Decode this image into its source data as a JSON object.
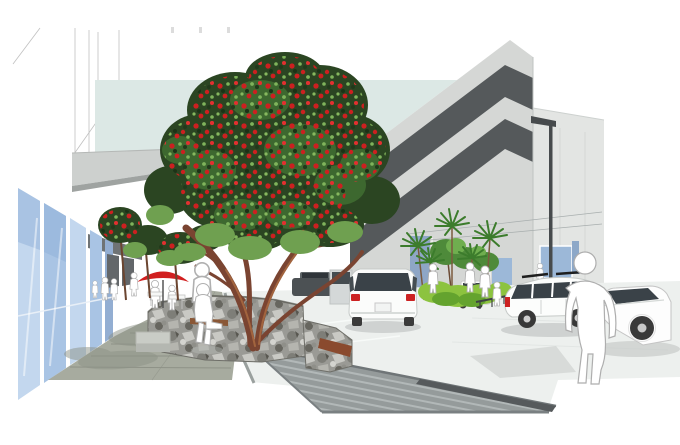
{
  "scene": {
    "type": "architectural concept rendering",
    "setting": "shared street with flowering pohutukawa trees, cafe seating, footpath, parking court and parking building",
    "background": "#ffffff"
  },
  "counts": {
    "pedestrian_figures": 14,
    "cars": 7,
    "street_lights": 1,
    "umbrellas": 1,
    "cabbage_trees": 5
  },
  "elements": [
    "left retail verandah and glazed shopfronts",
    "pedestrian footpath with paving joints",
    "cafe tables with red umbrella",
    "stone planter wall with timber seat",
    "large pohutukawa street tree in red flower",
    "smaller flowering street trees",
    "banded pedestrian ramp paving",
    "parking court with white cars",
    "cabbage trees and lime-green hedge planting",
    "parking building with dark window bands",
    "street light",
    "white cut-out pedestrian figures"
  ],
  "palette": {
    "sky": "#dce8e5",
    "storefront_glass": "#a9c4e4",
    "storefront_glass_light": "#c3d7ee",
    "storefront_glass_deep": "#93aed2",
    "canopy": "#cdd0ce",
    "canopy_edge": "#9fa3a1",
    "canopy_dark": "#6f7375",
    "outline_gray": "#c0c0c0",
    "building_face": "#d5d7d5",
    "building_face_front": "#e3e5e3",
    "building_band": "#55595b",
    "glass_blue": "#9cb8d8",
    "road": "#edf0ee",
    "sidewalk": "#a7ab9f",
    "sidewalk_joint": "#8e9287",
    "ramp": "#959b9b",
    "ramp_stripe": "#b2b8b8",
    "ramp_edge": "#6f7577",
    "channel_dark": "#565a5c",
    "rock": "#9a9a95",
    "rust_patch": "#8a4a2e",
    "foliage_dark": "#2b4522",
    "foliage_mid": "#3f6a30",
    "foliage_light": "#6fa050",
    "flower_red": "#cc2020",
    "trunk": "#7a4431",
    "trunk_light": "#a2643e",
    "frond_green": "#3c7c2c",
    "hedge_green": "#8cc33f",
    "hedge_shade": "#64a32e",
    "umbrella_red": "#d11f1f",
    "figure_fill": "#ffffff",
    "figure_outline": "#b0b0b0",
    "car_glass": "#3a4248",
    "taillight_red": "#cc2222",
    "wheel": "#3a3a3a",
    "metal_dark": "#474b4d",
    "shadow": "#c7cbc9",
    "ground_shadow": "#8d9287",
    "bench_wood": "#8a5736"
  }
}
